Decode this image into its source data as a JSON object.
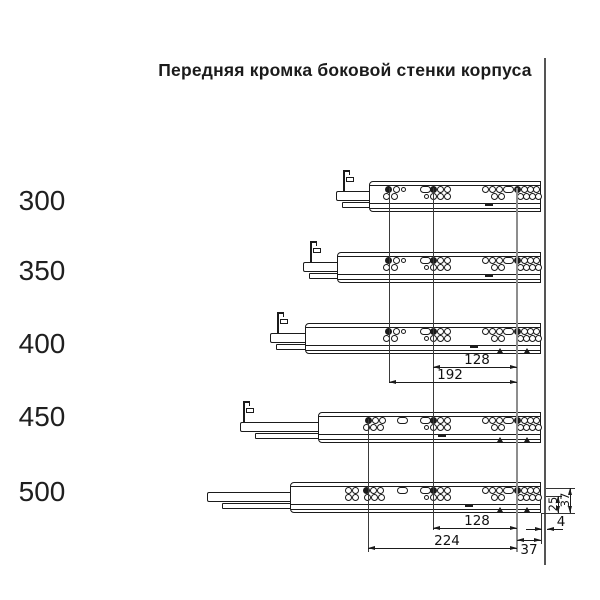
{
  "title": "Передняя кромка боковой стенки корпуса",
  "colors": {
    "ink": "#1b1b1b",
    "ref_line": "#3a3a3a",
    "front_hole_line": "#8d8d8d",
    "corpus_edge": "#555555",
    "dim_text": "#111111",
    "background": "#ffffff"
  },
  "rail_right_x": 541,
  "corpus_edge": {
    "x": 543.5,
    "w": 2.5,
    "y1": 58,
    "y2": 565
  },
  "rails": [
    {
      "label": "300",
      "label_center_y": 201,
      "body_x": 369,
      "body_y": 181,
      "bar_x": 336,
      "pin_x": 343,
      "lower_dx": 6,
      "clusters": [
        "c389",
        "c433",
        "c495",
        "c517"
      ],
      "dash_x": 485,
      "tri": []
    },
    {
      "label": "350",
      "label_center_y": 271,
      "body_x": 337,
      "body_y": 252,
      "bar_x": 303,
      "pin_x": 310,
      "lower_dx": 6,
      "clusters": [
        "c389",
        "c433",
        "c495",
        "c517"
      ],
      "dash_x": 485,
      "tri": []
    },
    {
      "label": "400",
      "label_center_y": 344,
      "body_x": 305,
      "body_y": 323,
      "bar_x": 270,
      "pin_x": 277,
      "lower_dx": 6,
      "clusters": [
        "c389",
        "c433",
        "c495",
        "c517"
      ],
      "dash_x": 470,
      "tri": [
        500,
        527
      ]
    },
    {
      "label": "450",
      "label_center_y": 417,
      "body_x": 318,
      "body_y": 412,
      "bar_x": 240,
      "pin_x": 243,
      "lower_dx": 15,
      "clusters": [
        "c368a",
        "slot400",
        "c433",
        "c495",
        "c517"
      ],
      "dash_x": 438,
      "tri": [
        500,
        527
      ]
    },
    {
      "label": "500",
      "label_center_y": 492,
      "body_x": 290,
      "body_y": 482,
      "bar_x": 207,
      "pin_x": null,
      "lower_dx": 15,
      "clusters": [
        "c368b",
        "slot400",
        "c433",
        "c495",
        "c517"
      ],
      "dash_x": 465,
      "tri": [
        500,
        527
      ]
    }
  ],
  "ref_lines": [
    {
      "x": 389,
      "y1": 188,
      "y2": 382,
      "w": 1,
      "light": false
    },
    {
      "x": 433,
      "y1": 188,
      "y2": 530,
      "w": 1,
      "light": false
    },
    {
      "x": 517,
      "y1": 188,
      "y2": 552,
      "w": 2,
      "light": true
    },
    {
      "x": 368,
      "y1": 419,
      "y2": 552,
      "w": 1,
      "light": false
    }
  ],
  "ext_lines": [
    {
      "o": "h",
      "y": 488,
      "x1": 546,
      "x2": 575
    },
    {
      "o": "h",
      "y": 496,
      "x1": 546,
      "x2": 562
    },
    {
      "o": "h",
      "y": 513,
      "x1": 541,
      "x2": 575
    },
    {
      "o": "v",
      "x": 541.5,
      "y1": 514,
      "y2": 544
    }
  ],
  "dims": [
    {
      "label": "128",
      "type": "h",
      "x1": 433,
      "x2": 517,
      "y": 367,
      "tx": 477,
      "ty": 352
    },
    {
      "label": "192",
      "type": "h",
      "x1": 389,
      "x2": 517,
      "y": 382,
      "tx": 450,
      "ty": 367
    },
    {
      "label": "128",
      "type": "h",
      "x1": 433,
      "x2": 517,
      "y": 528,
      "tx": 477,
      "ty": 513
    },
    {
      "label": "224",
      "type": "h",
      "x1": 368,
      "x2": 517,
      "y": 548,
      "tx": 447,
      "ty": 533
    },
    {
      "label": "37",
      "type": "h",
      "x1": 517,
      "x2": 541,
      "y": 540,
      "tx": 529,
      "ty": 542
    },
    {
      "label": "4",
      "type": "hout",
      "x1": 541.5,
      "x2": 546.5,
      "y": 529,
      "tx": 561,
      "ty": 514
    },
    {
      "label": "25",
      "type": "v",
      "x": 558,
      "y1": 496,
      "y2": 513,
      "tx": 553,
      "ty": 504
    },
    {
      "label": "37",
      "type": "v",
      "x": 570,
      "y1": 488,
      "y2": 513,
      "tx": 565,
      "ty": 500
    }
  ]
}
